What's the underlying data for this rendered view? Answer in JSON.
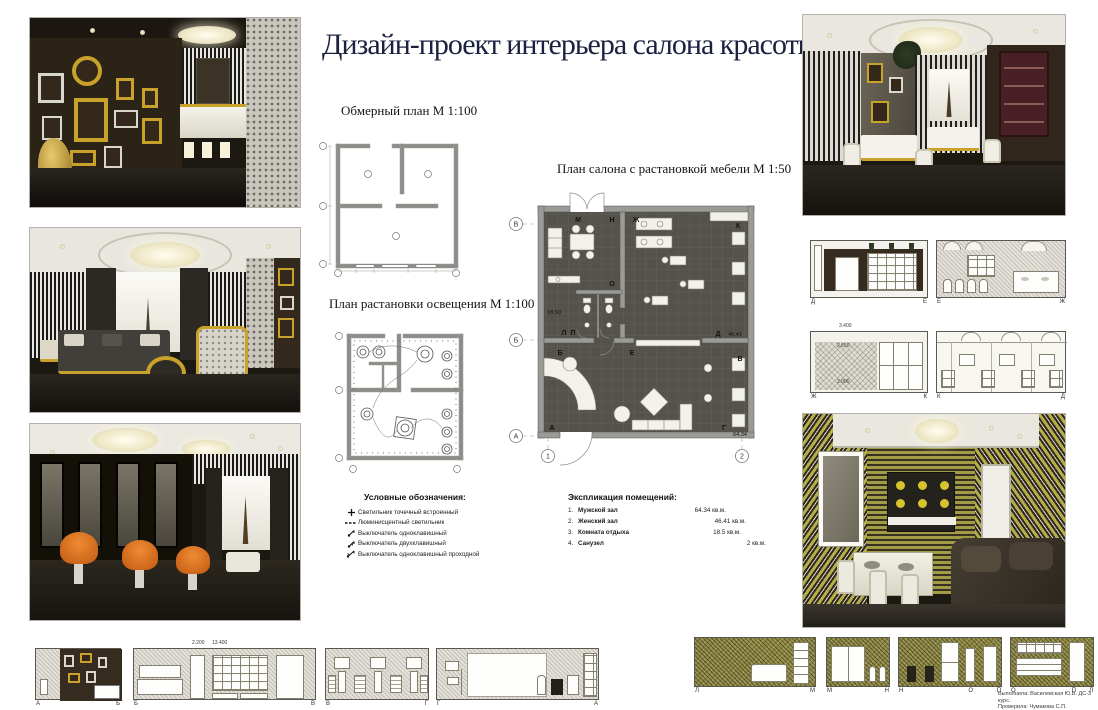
{
  "title": "Дизайн-проект интерьера салона красоты",
  "plans": {
    "measure": {
      "label": "Обмерный план М 1:100"
    },
    "lighting": {
      "label": "План растановки освещения М 1:100"
    },
    "furniture": {
      "label": "План салона с растановкой мебели М 1:50",
      "letters": {
        "m": "М",
        "n": "Н",
        "zh": "Ж",
        "k": "К",
        "o": "О",
        "l": "Л",
        "p": "П",
        "b": "Б",
        "e": "Е",
        "d": "Д",
        "v": "В",
        "a": "А",
        "g": "Г"
      },
      "areas": {
        "rest": "18.50",
        "women": "46.41",
        "men": "64.34"
      },
      "axes": {
        "v": "В",
        "b": "Б",
        "a": "А",
        "n1": "1",
        "n2": "2"
      }
    }
  },
  "legend": {
    "title": "Условные обозначения:",
    "items": [
      {
        "icon": "spot-light-icon",
        "label": "Светильник точечный встроенный"
      },
      {
        "icon": "fluorescent-light-icon",
        "label": "Люминисцентный светильник"
      },
      {
        "icon": "switch-single-icon",
        "label": "Выключатель одноклавишный"
      },
      {
        "icon": "switch-double-icon",
        "label": "Выключатель двухклавишный"
      },
      {
        "icon": "switch-pass-icon",
        "label": "Выключатель одноклавишный проходной"
      }
    ]
  },
  "explication": {
    "title": "Экспликация помещений:",
    "rows": [
      {
        "num": "1.",
        "name": "Мужской зал",
        "area": "64.34 кв.м."
      },
      {
        "num": "2.",
        "name": "Женский зал",
        "area": "46.41 кв.м."
      },
      {
        "num": "3.",
        "name": "Комната отдыха",
        "area": "18.5 кв.м."
      },
      {
        "num": "4.",
        "name": "Санузел",
        "area": "2 кв.м."
      }
    ]
  },
  "elevations": {
    "right_row1": [
      {
        "left": "Д",
        "right": "Е"
      },
      {
        "left": "Е",
        "right": "Ж"
      }
    ],
    "right_row2": [
      {
        "left": "Ж",
        "right": "К",
        "dim_top": "3.400",
        "dim_mid": "2.650",
        "dim_low": "2.000"
      },
      {
        "left": "К",
        "right": "Д"
      }
    ],
    "bottom_left": [
      {
        "left": "А",
        "right": "Б"
      },
      {
        "left": "Б",
        "right": "В",
        "dim_a": "2.200",
        "dim_b": "13.400"
      },
      {
        "left": "В",
        "right": "Г"
      },
      {
        "left": "Г",
        "right": "А",
        "dim_a": "12.600"
      }
    ],
    "bottom_right": [
      {
        "left": "Л",
        "right": "М"
      },
      {
        "left": "М",
        "right": "Н"
      },
      {
        "left": "Н",
        "mid": "О",
        "right": "П"
      },
      {
        "left": "О",
        "mid": "П",
        "right": "Л"
      }
    ]
  },
  "credits": {
    "line1": "Выполнила: Василевская Ю.В. ДС-3 курс.",
    "line2": "Проверила: Чумакова С.П."
  },
  "colors": {
    "title": "#1b2240",
    "gold": "#c9a22b",
    "orange": "#d96d1f",
    "olive": "#8e8840",
    "wall_dark": "#362b1f",
    "plan_floor": "#55524b"
  }
}
